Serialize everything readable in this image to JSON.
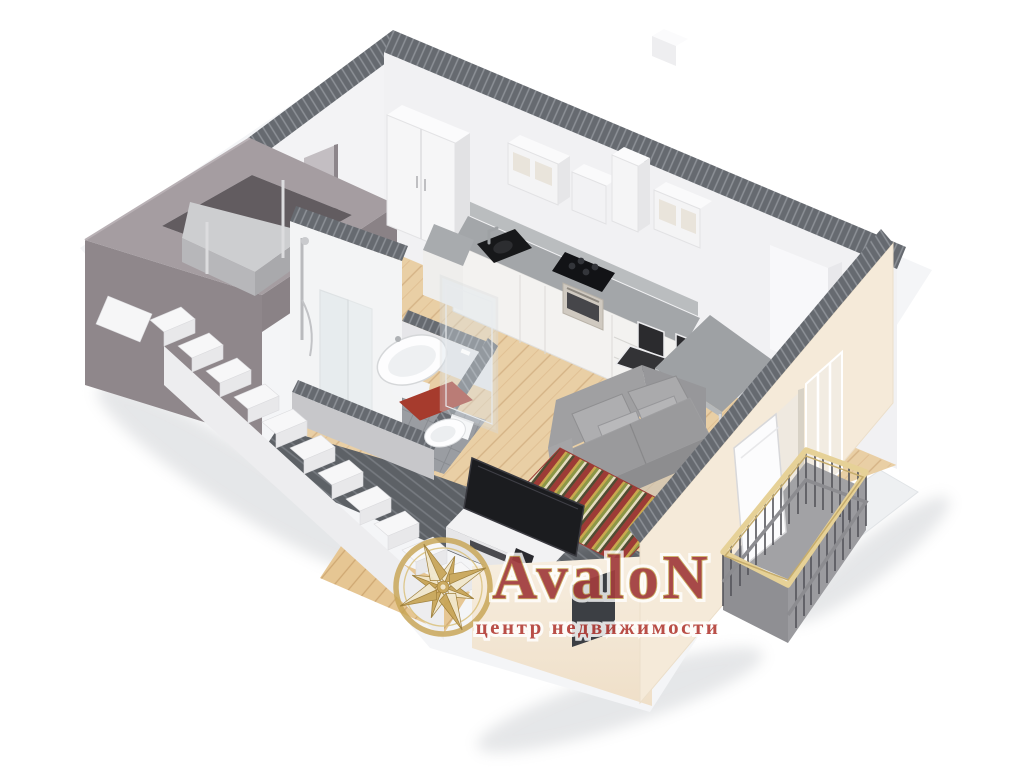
{
  "image": {
    "kind": "3d-floor-plan-render",
    "view": "isometric cutaway",
    "subject": "studio apartment with entry hall, bathroom, kitchen-dining area, living area, balcony and stairwell with elevator"
  },
  "logo": {
    "emblem": "compass-rose",
    "title": "AvaloN",
    "subtitle": "центр недвижимости",
    "title_fill": "#a23d3e",
    "title_outline": "#c8a557",
    "subtitle_fill": "#b5433d",
    "halo": "#ffffff",
    "gold": "#c8a557"
  },
  "palette": {
    "background": "#ffffff",
    "cut_wall_hatch": "#666a70",
    "interior_wall": "#f2f2f4",
    "exterior_cream": "#f5ead9",
    "stairwell_gray": "#90888c",
    "wood_floor": "#e9cfa5",
    "bath_tile": "#9a9da2",
    "hall_tile_dark": "#5d6166",
    "countertop": "#a3a6a9",
    "appliance_black": "#1b1c1f",
    "sofa_gray": "#9e9ea0",
    "rug_red": "#9d3b36",
    "rug_olive": "#8c9747",
    "rug_cream": "#e5ddc0",
    "rug_gold": "#c9a84e",
    "bath_mat_red": "#a63b2d",
    "handrail_gold": "#e6d197",
    "balcony_floor": "#a2a2a5",
    "elevator_cab": "#cdced0"
  },
  "scene": {
    "rooms": [
      "stairwell-with-elevator",
      "entry-hall",
      "bathroom",
      "kitchen-dining",
      "living-area",
      "balcony"
    ],
    "objects": [
      "staircase",
      "elevator-cab",
      "wardrobe",
      "kitchen-wall-cabinets",
      "cooker-hood",
      "kitchen-counter",
      "kitchen-sink",
      "gas-hob",
      "oven",
      "dining-table",
      "dining-chairs",
      "sofa",
      "cushions",
      "tv",
      "tv-stand",
      "striped-rug",
      "shower",
      "washbasin",
      "toilet",
      "bath-mat",
      "glass-door",
      "balcony-railing",
      "balcony-door"
    ]
  }
}
